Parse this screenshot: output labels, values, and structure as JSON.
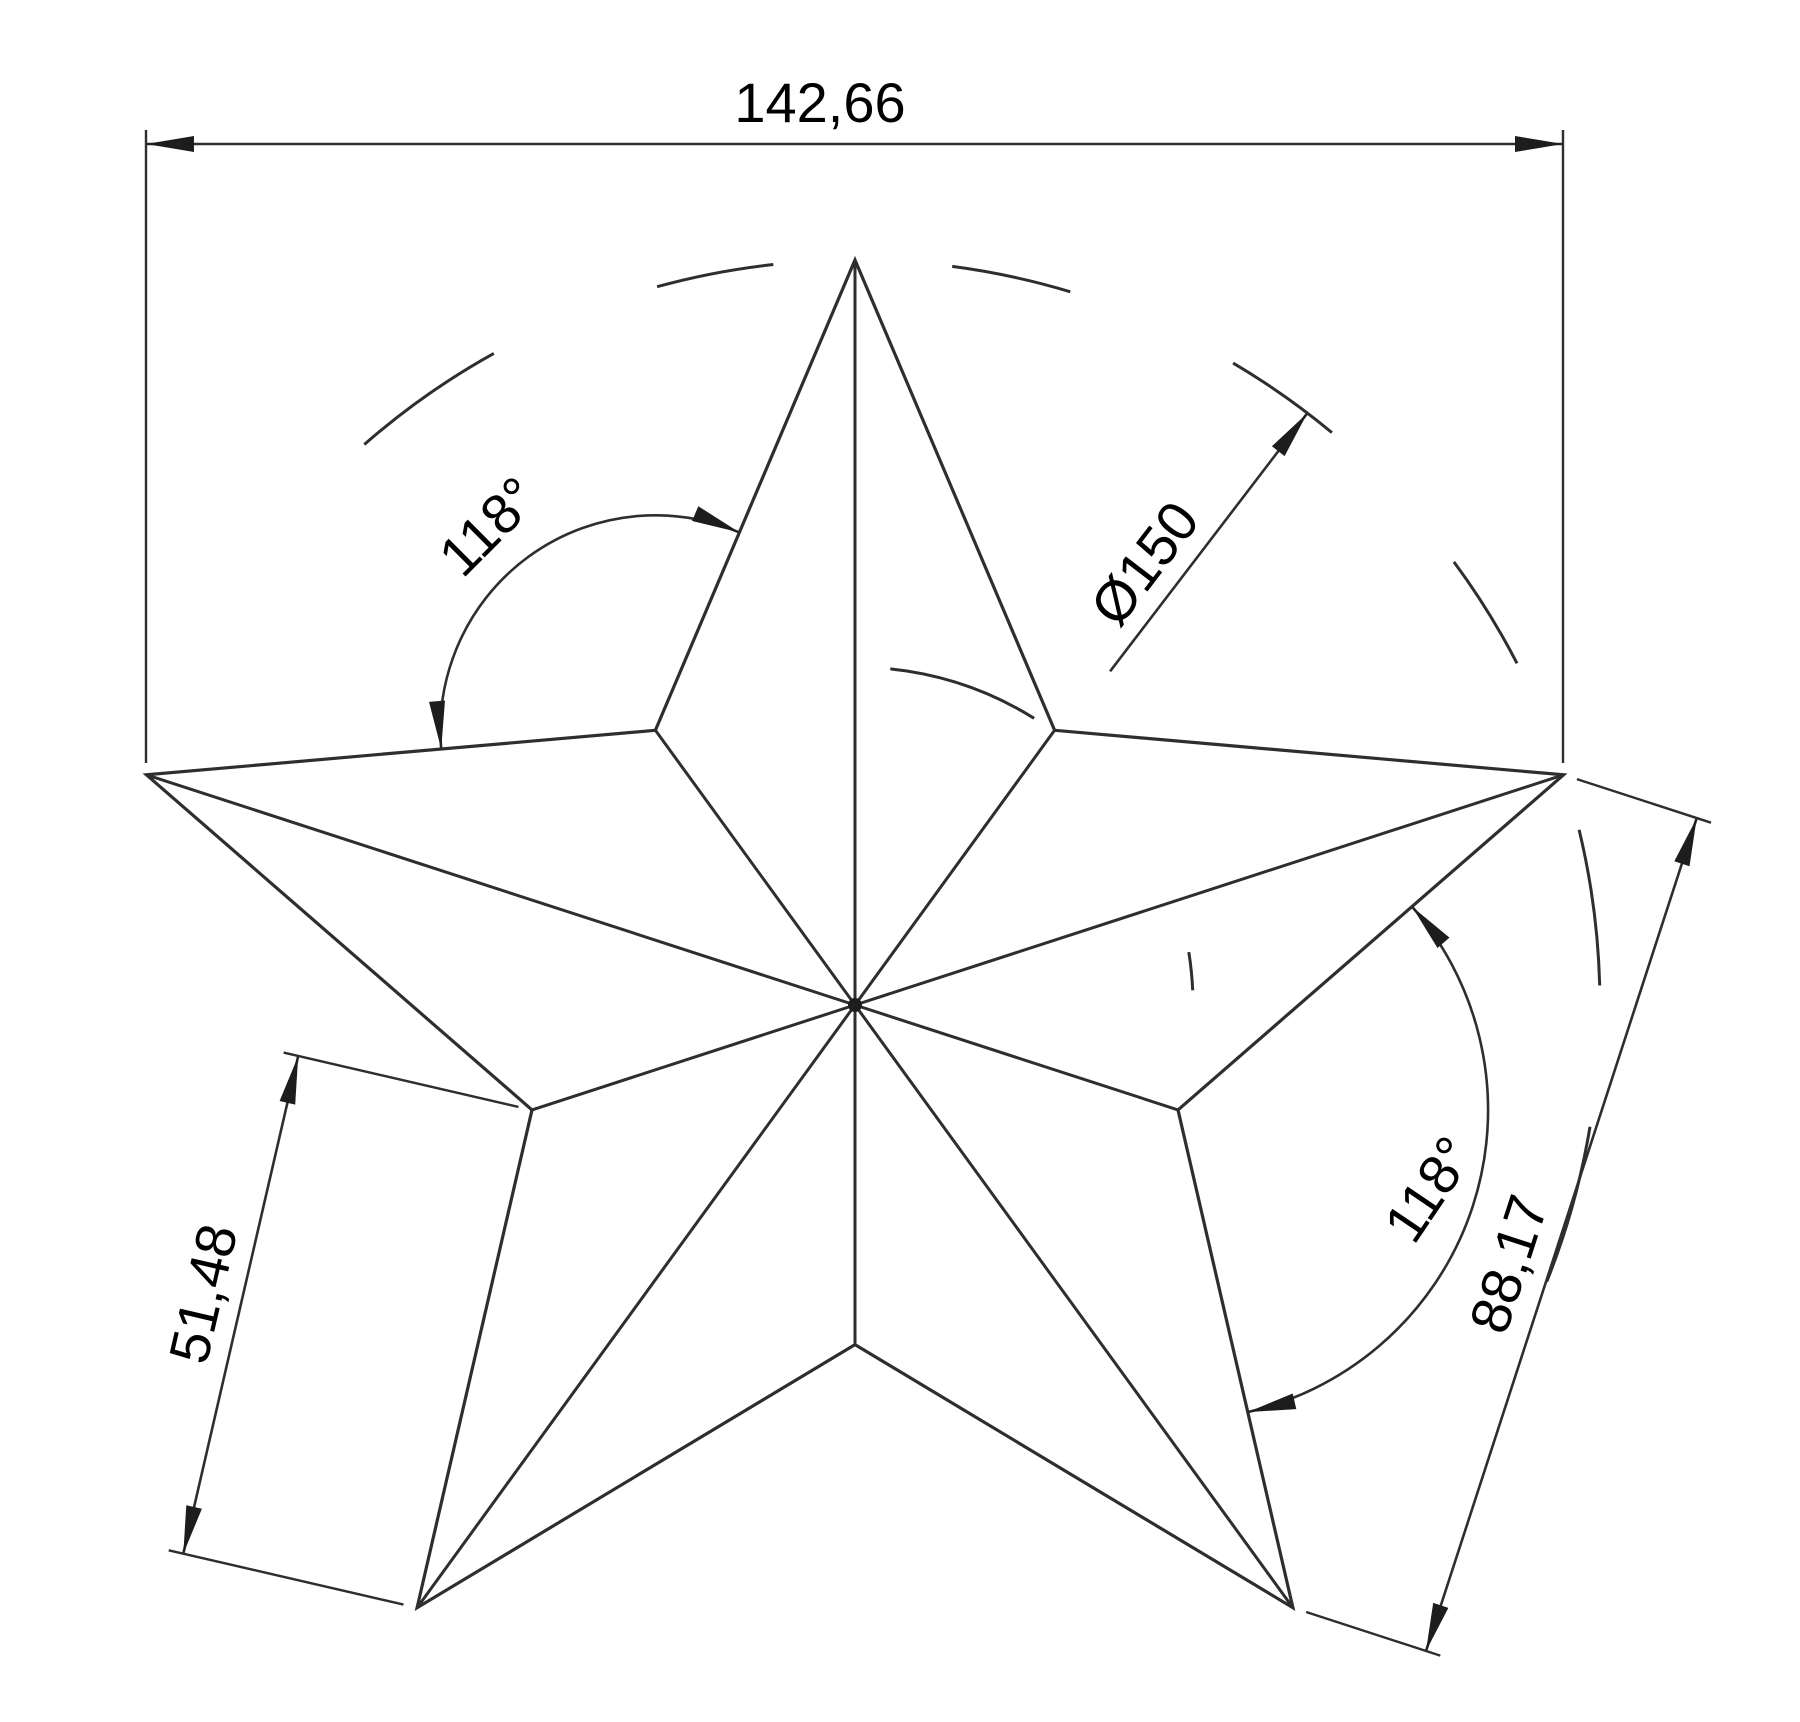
{
  "drawing": {
    "title": "five-pointed-star-dimensioned-drawing",
    "dimensions": {
      "overall_width": "142,66",
      "circumscribed_diameter": "Ø150",
      "notch_angle_upper_left": "118°",
      "notch_angle_lower_right": "118°",
      "edge_length": "51,48",
      "point_chord_length": "88,17"
    },
    "colors": {
      "line": "#2e2e2e",
      "text": "#000000",
      "background": "#ffffff"
    }
  }
}
